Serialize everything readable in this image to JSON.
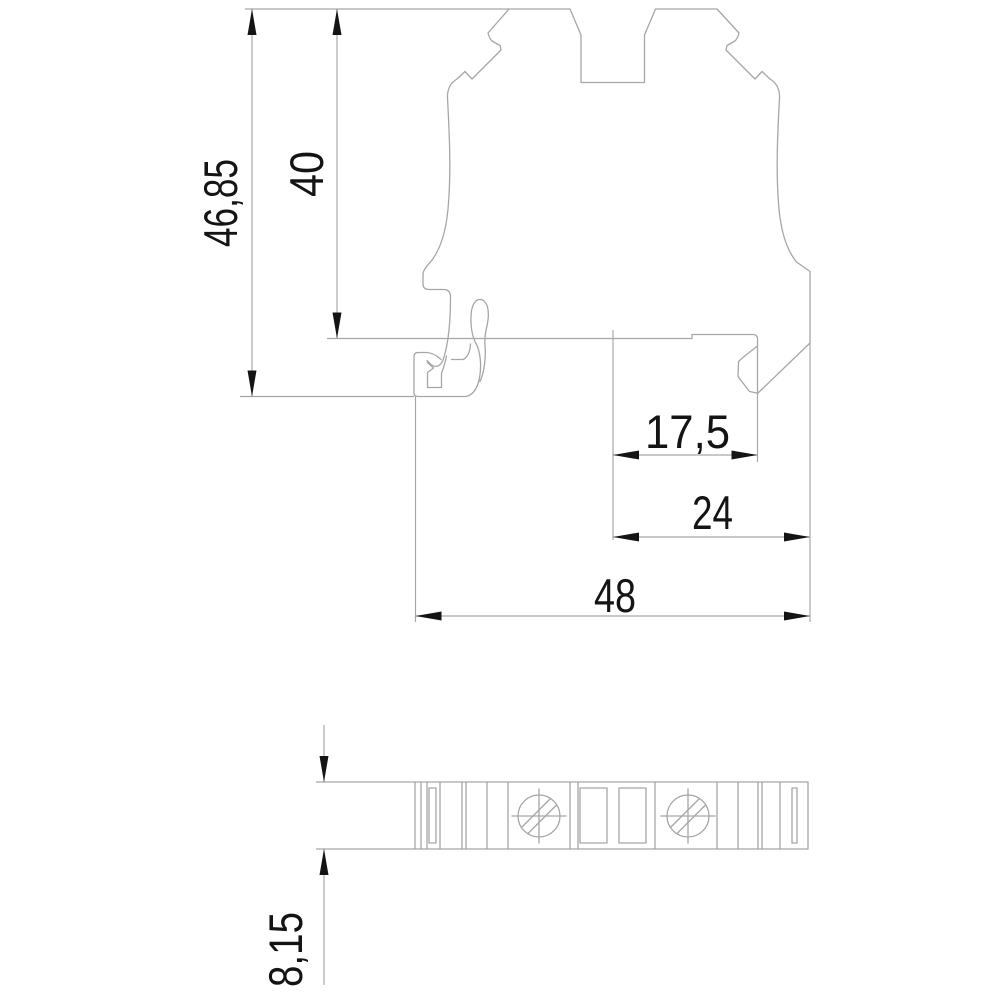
{
  "dimensions": {
    "total_height": "46,85",
    "upper_height": "40",
    "rail_to_edge": "17,5",
    "center_to_edge": "24",
    "total_width": "48",
    "depth": "8,15"
  },
  "colors": {
    "background": "#ffffff",
    "outline": "#a6a6a6",
    "dimension_line": "#a6a6a6",
    "arrow": "#141414",
    "label_text": "#141414"
  }
}
